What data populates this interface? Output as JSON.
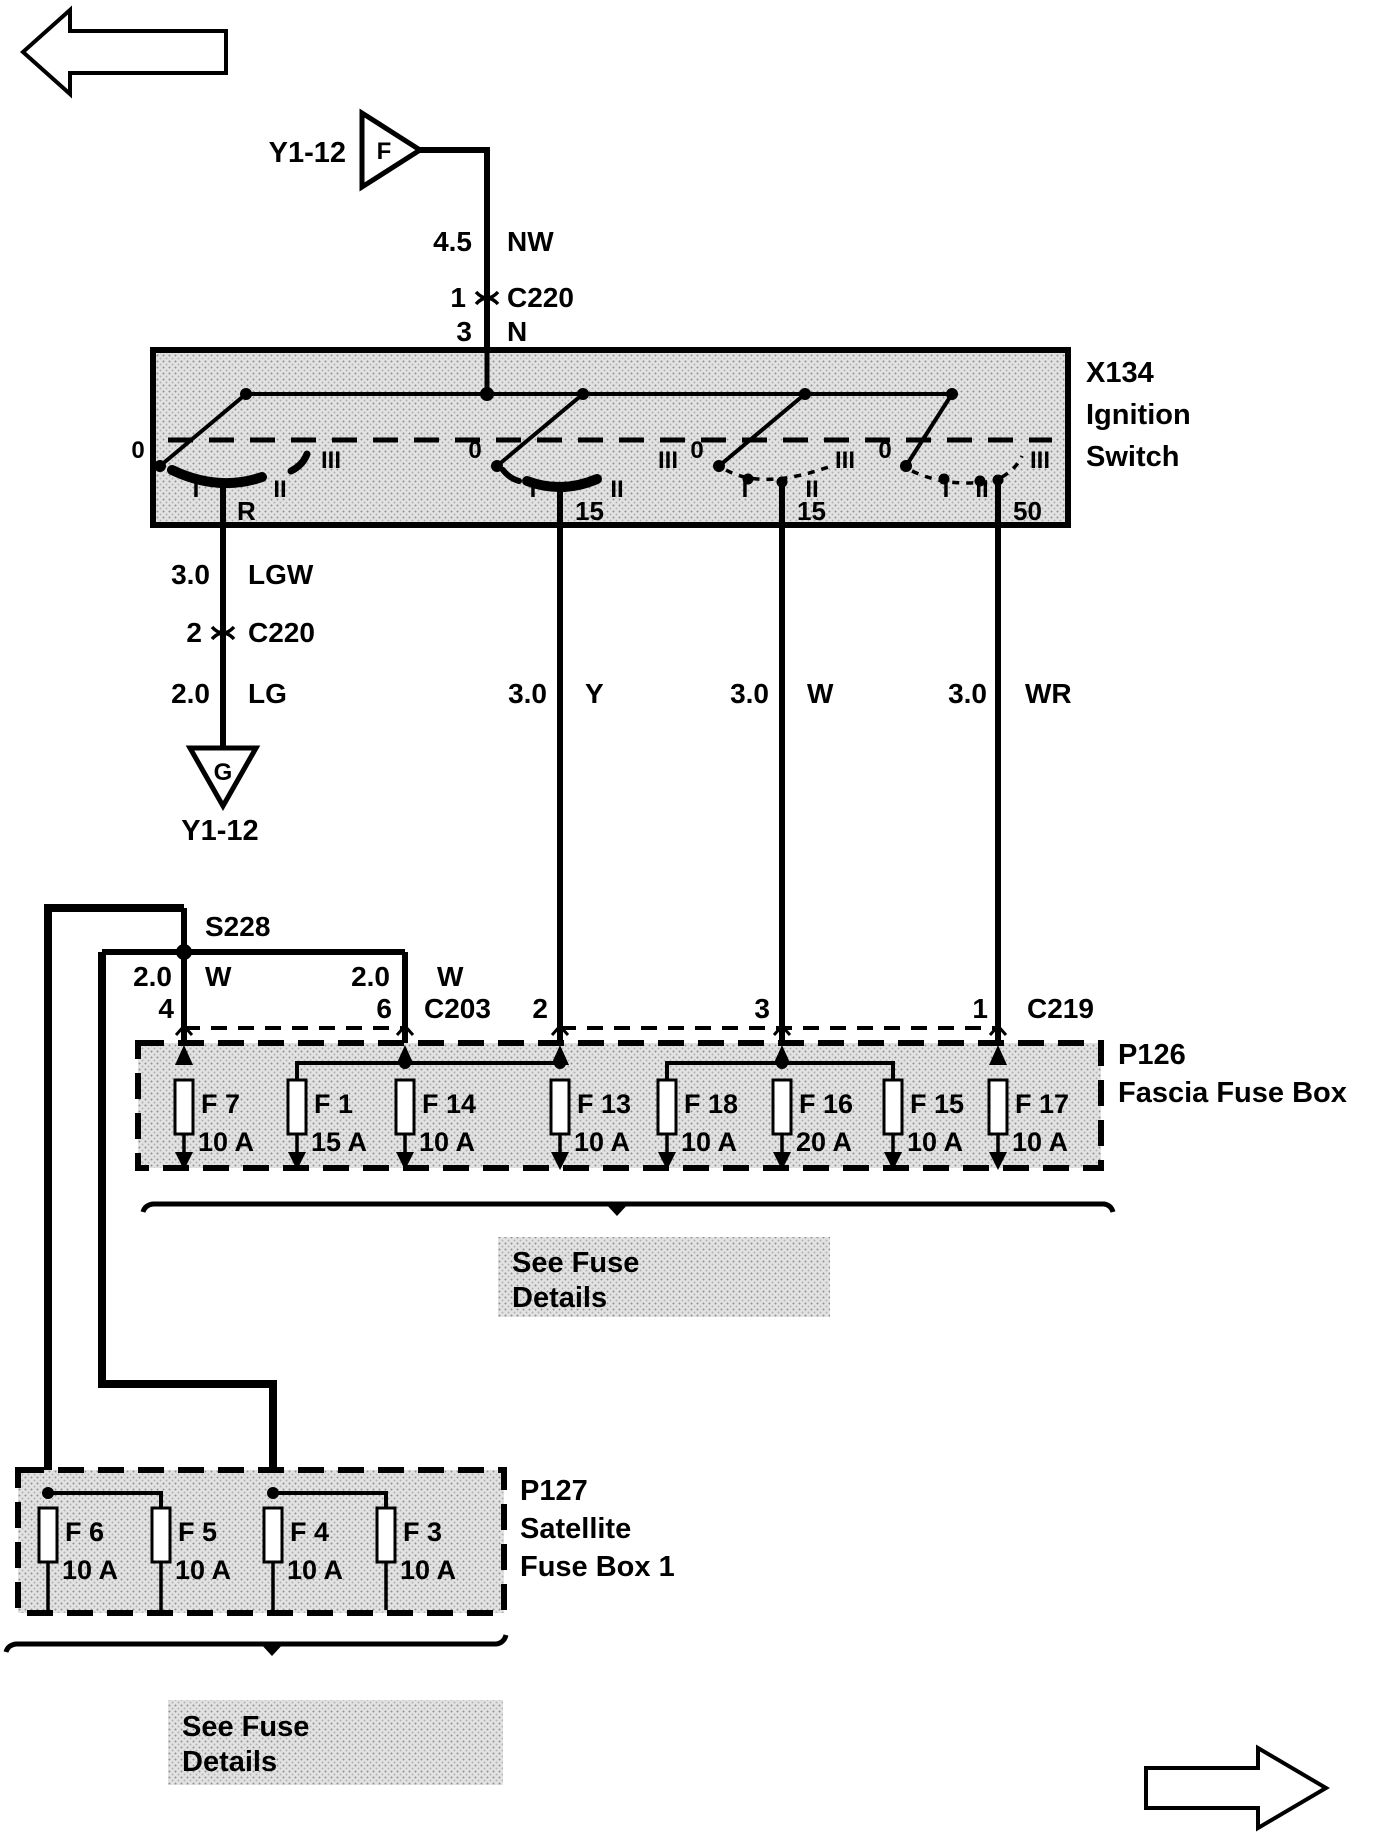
{
  "colors": {
    "ink": "#000000",
    "paper": "#ffffff",
    "box_fill": "#e2e2e2"
  },
  "icons": {
    "top_left": "arrow-left",
    "bottom_right": "arrow-right"
  },
  "feed": {
    "connector_letter": "F",
    "connector_label": "Y1-12",
    "wire_size": "4.5",
    "wire_color": "NW",
    "inline_pin": "1",
    "inline_connector": "C220",
    "switch_pin": "3",
    "switch_pin_color": "N"
  },
  "ignition_switch": {
    "id": "X134",
    "name1": "Ignition",
    "name2": "Switch",
    "positions": [
      "0",
      "I",
      "II",
      "III"
    ],
    "terminals": [
      "R",
      "15",
      "15",
      "50"
    ]
  },
  "r_branch": {
    "seg1_size": "3.0",
    "seg1_color": "LGW",
    "pin": "2",
    "connector": "C220",
    "seg2_size": "2.0",
    "seg2_color": "LG",
    "ground_letter": "G",
    "ground_label": "Y1-12"
  },
  "feeds_down": {
    "y": {
      "size": "3.0",
      "color": "Y"
    },
    "w": {
      "size": "3.0",
      "color": "W"
    },
    "wr": {
      "size": "3.0",
      "color": "WR"
    }
  },
  "splice": {
    "id": "S228",
    "left": {
      "size": "2.0",
      "color": "W",
      "pin": "4"
    },
    "right": {
      "size": "2.0",
      "color": "W",
      "pin": "6"
    },
    "connector": "C203"
  },
  "c219": {
    "pin_a": "2",
    "pin_b": "3",
    "pin_c": "1",
    "name": "C219"
  },
  "fascia_box": {
    "id": "P126",
    "name": "Fascia Fuse Box",
    "fuses": [
      {
        "id": "F 7",
        "rating": "10 A"
      },
      {
        "id": "F 1",
        "rating": "15 A"
      },
      {
        "id": "F 14",
        "rating": "10 A"
      },
      {
        "id": "F 13",
        "rating": "10 A"
      },
      {
        "id": "F 18",
        "rating": "10 A"
      },
      {
        "id": "F 16",
        "rating": "20 A"
      },
      {
        "id": "F 15",
        "rating": "10 A"
      },
      {
        "id": "F 17",
        "rating": "10 A"
      }
    ],
    "note1": "See Fuse",
    "note2": "Details"
  },
  "satellite_box": {
    "id": "P127",
    "name1": "Satellite",
    "name2": "Fuse Box 1",
    "fuses": [
      {
        "id": "F 6",
        "rating": "10 A"
      },
      {
        "id": "F 5",
        "rating": "10 A"
      },
      {
        "id": "F 4",
        "rating": "10 A"
      },
      {
        "id": "F 3",
        "rating": "10 A"
      }
    ],
    "note1": "See Fuse",
    "note2": "Details"
  }
}
